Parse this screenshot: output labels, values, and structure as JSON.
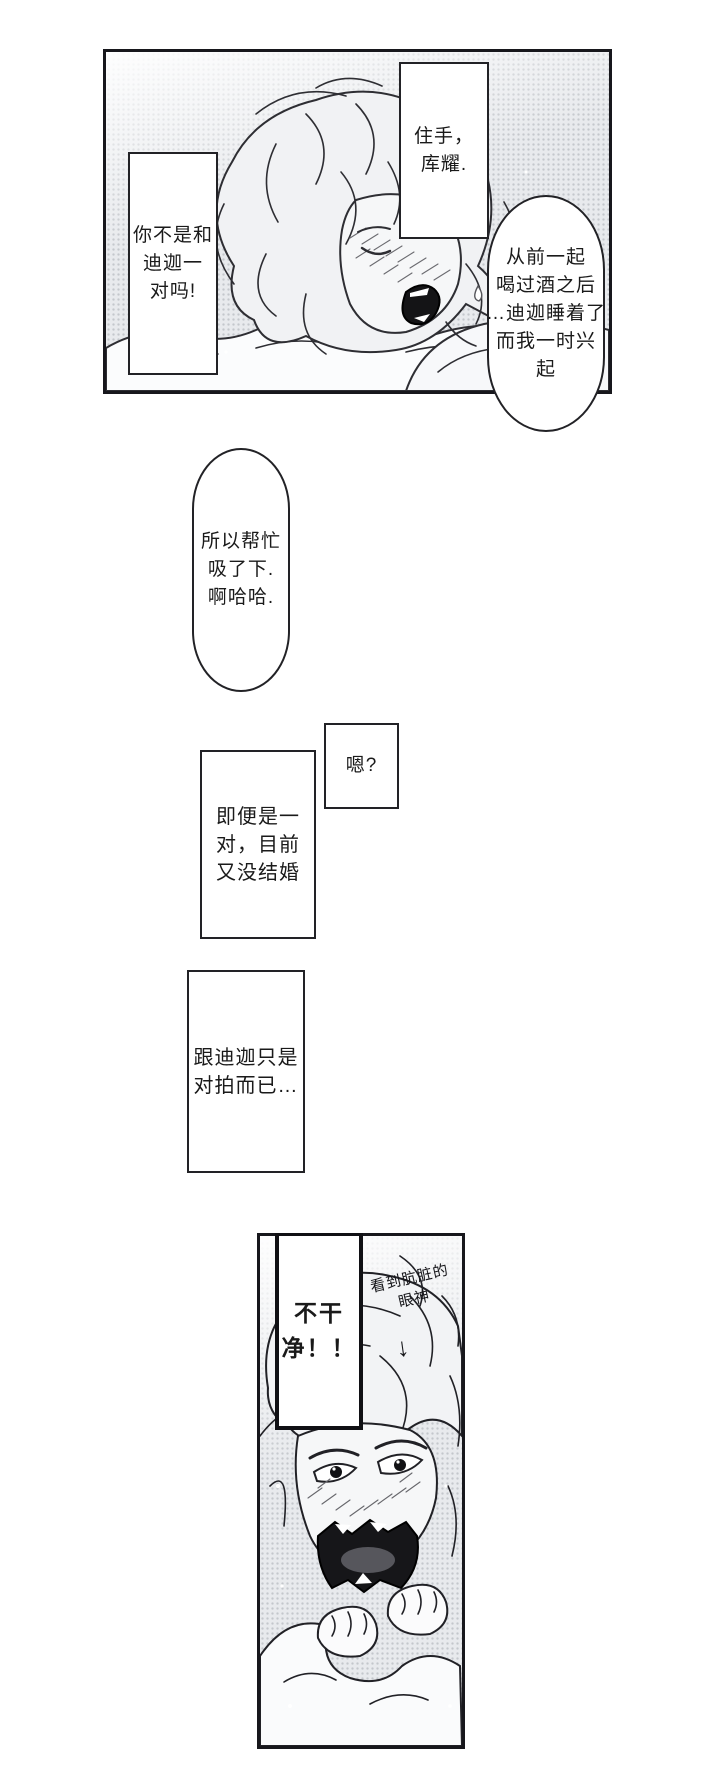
{
  "colors": {
    "paper": "#ffffff",
    "ink": "#1a1a1a",
    "panel_tone": "#e8eaed",
    "halftone_dot": "#c4c7cc"
  },
  "speech": {
    "stop": {
      "lines": [
        "住手，",
        "库耀."
      ]
    },
    "pair": {
      "lines": [
        "你不是和",
        "迪迦一",
        "对吗!"
      ]
    },
    "drink": {
      "lines": [
        "从前一起",
        "喝过酒之后",
        "…迪迦睡着了",
        "而我一时兴",
        "起"
      ]
    },
    "help": {
      "lines": [
        "所以帮忙",
        "吸了下.",
        "啊哈哈."
      ]
    },
    "huh": {
      "lines": [
        "嗯?"
      ]
    },
    "married": {
      "lines": [
        "即便是一",
        "对，目前",
        "又没结婚"
      ]
    },
    "partner": {
      "lines": [
        "跟迪迦只是",
        "对拍而已…"
      ]
    },
    "dirty": {
      "lines": [
        "不干",
        "净！！"
      ]
    },
    "note": {
      "lines": [
        "看到肮脏的",
        "眼神"
      ],
      "arrow": "↓"
    }
  }
}
